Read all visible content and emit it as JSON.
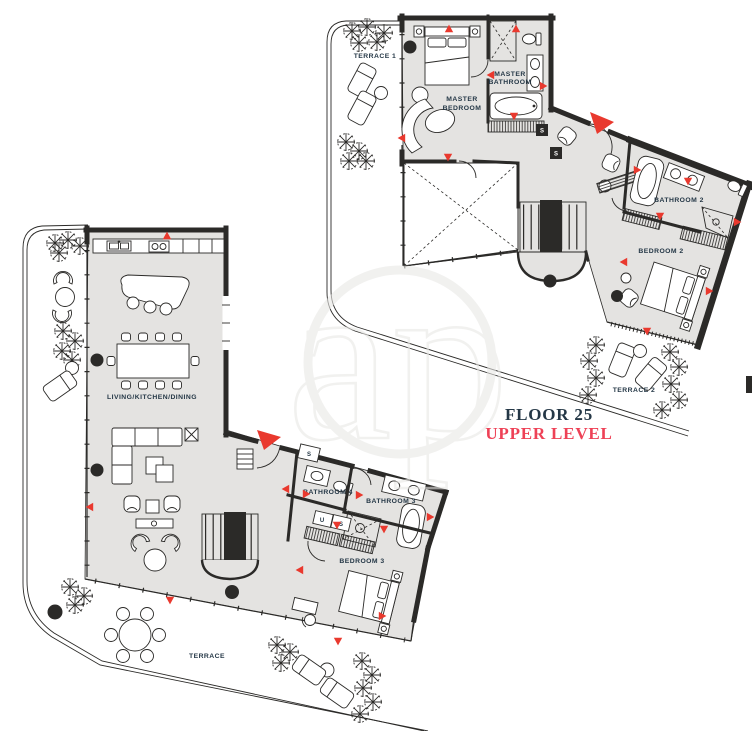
{
  "caption": {
    "floor": "FLOOR 25",
    "level": "UPPER LEVEL"
  },
  "watermark": "ap",
  "upper_level": {
    "terrace1": "TERRACE 1",
    "master_bedroom_line1": "MASTER",
    "master_bedroom_line2": "BEDROOM",
    "master_bathroom_line1": "MASTER",
    "master_bathroom_line2": "BATHROOM",
    "bathroom2": "BATHROOM 2",
    "bedroom2": "BEDROOM 2",
    "terrace2": "TERRACE 2",
    "storage1": "S",
    "storage2": "S"
  },
  "lower_level": {
    "living": "LIVING/KITCHEN/DINING",
    "bathroom4": "BATHROOM 4",
    "bathroom3": "BATHROOM 3",
    "bedroom3": "BEDROOM 3",
    "terrace": "TERRACE",
    "storage1": "S",
    "utility": "U",
    "storage2": "S"
  },
  "colors": {
    "wall": "#2b2a28",
    "ink": "#2b2a28",
    "floor": "#e4e3e1",
    "red": "#e9392e",
    "label_red": "#ee4156",
    "navy": "#243746",
    "wm": "#e9e8e6"
  }
}
